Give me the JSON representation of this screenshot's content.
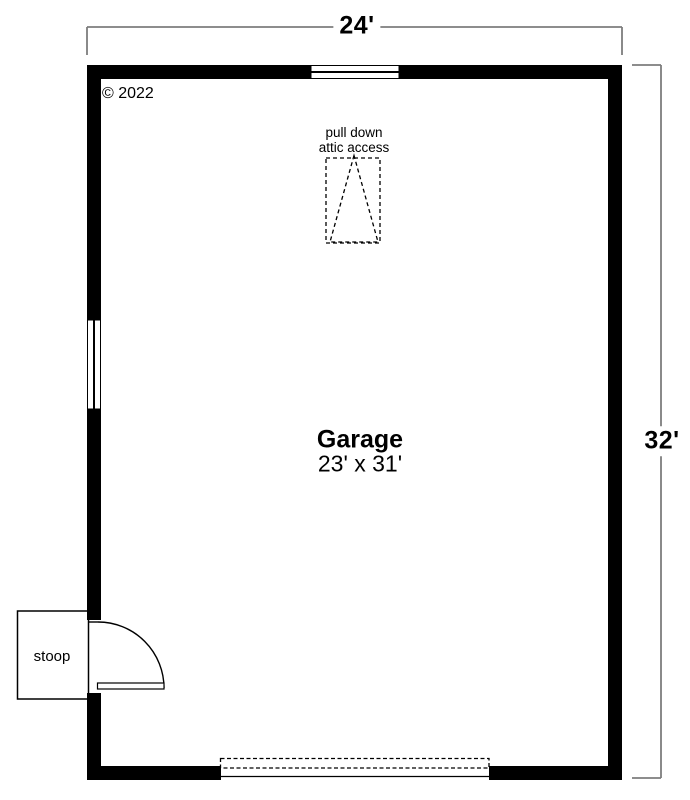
{
  "plan": {
    "copyright": "© 2022",
    "dimensions": {
      "top": "24'",
      "right": "32'"
    },
    "room": {
      "name": "Garage",
      "size": "23' x 31'"
    },
    "attic_access": {
      "line1": "pull down",
      "line2": "attic access"
    },
    "stoop": {
      "label": "stoop"
    }
  },
  "colors": {
    "wall": "#000000",
    "dimension_line": "#7d7d7d",
    "text": "#000000",
    "background": "#ffffff",
    "outline": "#000000"
  }
}
